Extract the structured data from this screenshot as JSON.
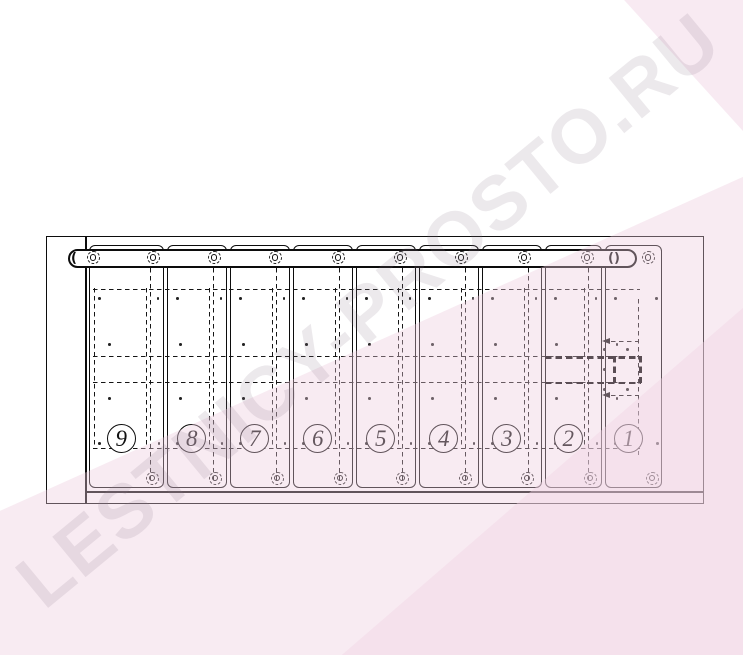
{
  "watermark": {
    "text": "LESTNICY-PROSTO.RU"
  },
  "diagram": {
    "slat_labels": [
      "9",
      "8",
      "7",
      "6",
      "5",
      "4",
      "3",
      "2",
      "1"
    ],
    "colors": {
      "line": "#0c0c0c",
      "background": "#ffffff",
      "pink_tint": "#f6e9f1",
      "watermark_gray": "#e9e6e8"
    }
  }
}
